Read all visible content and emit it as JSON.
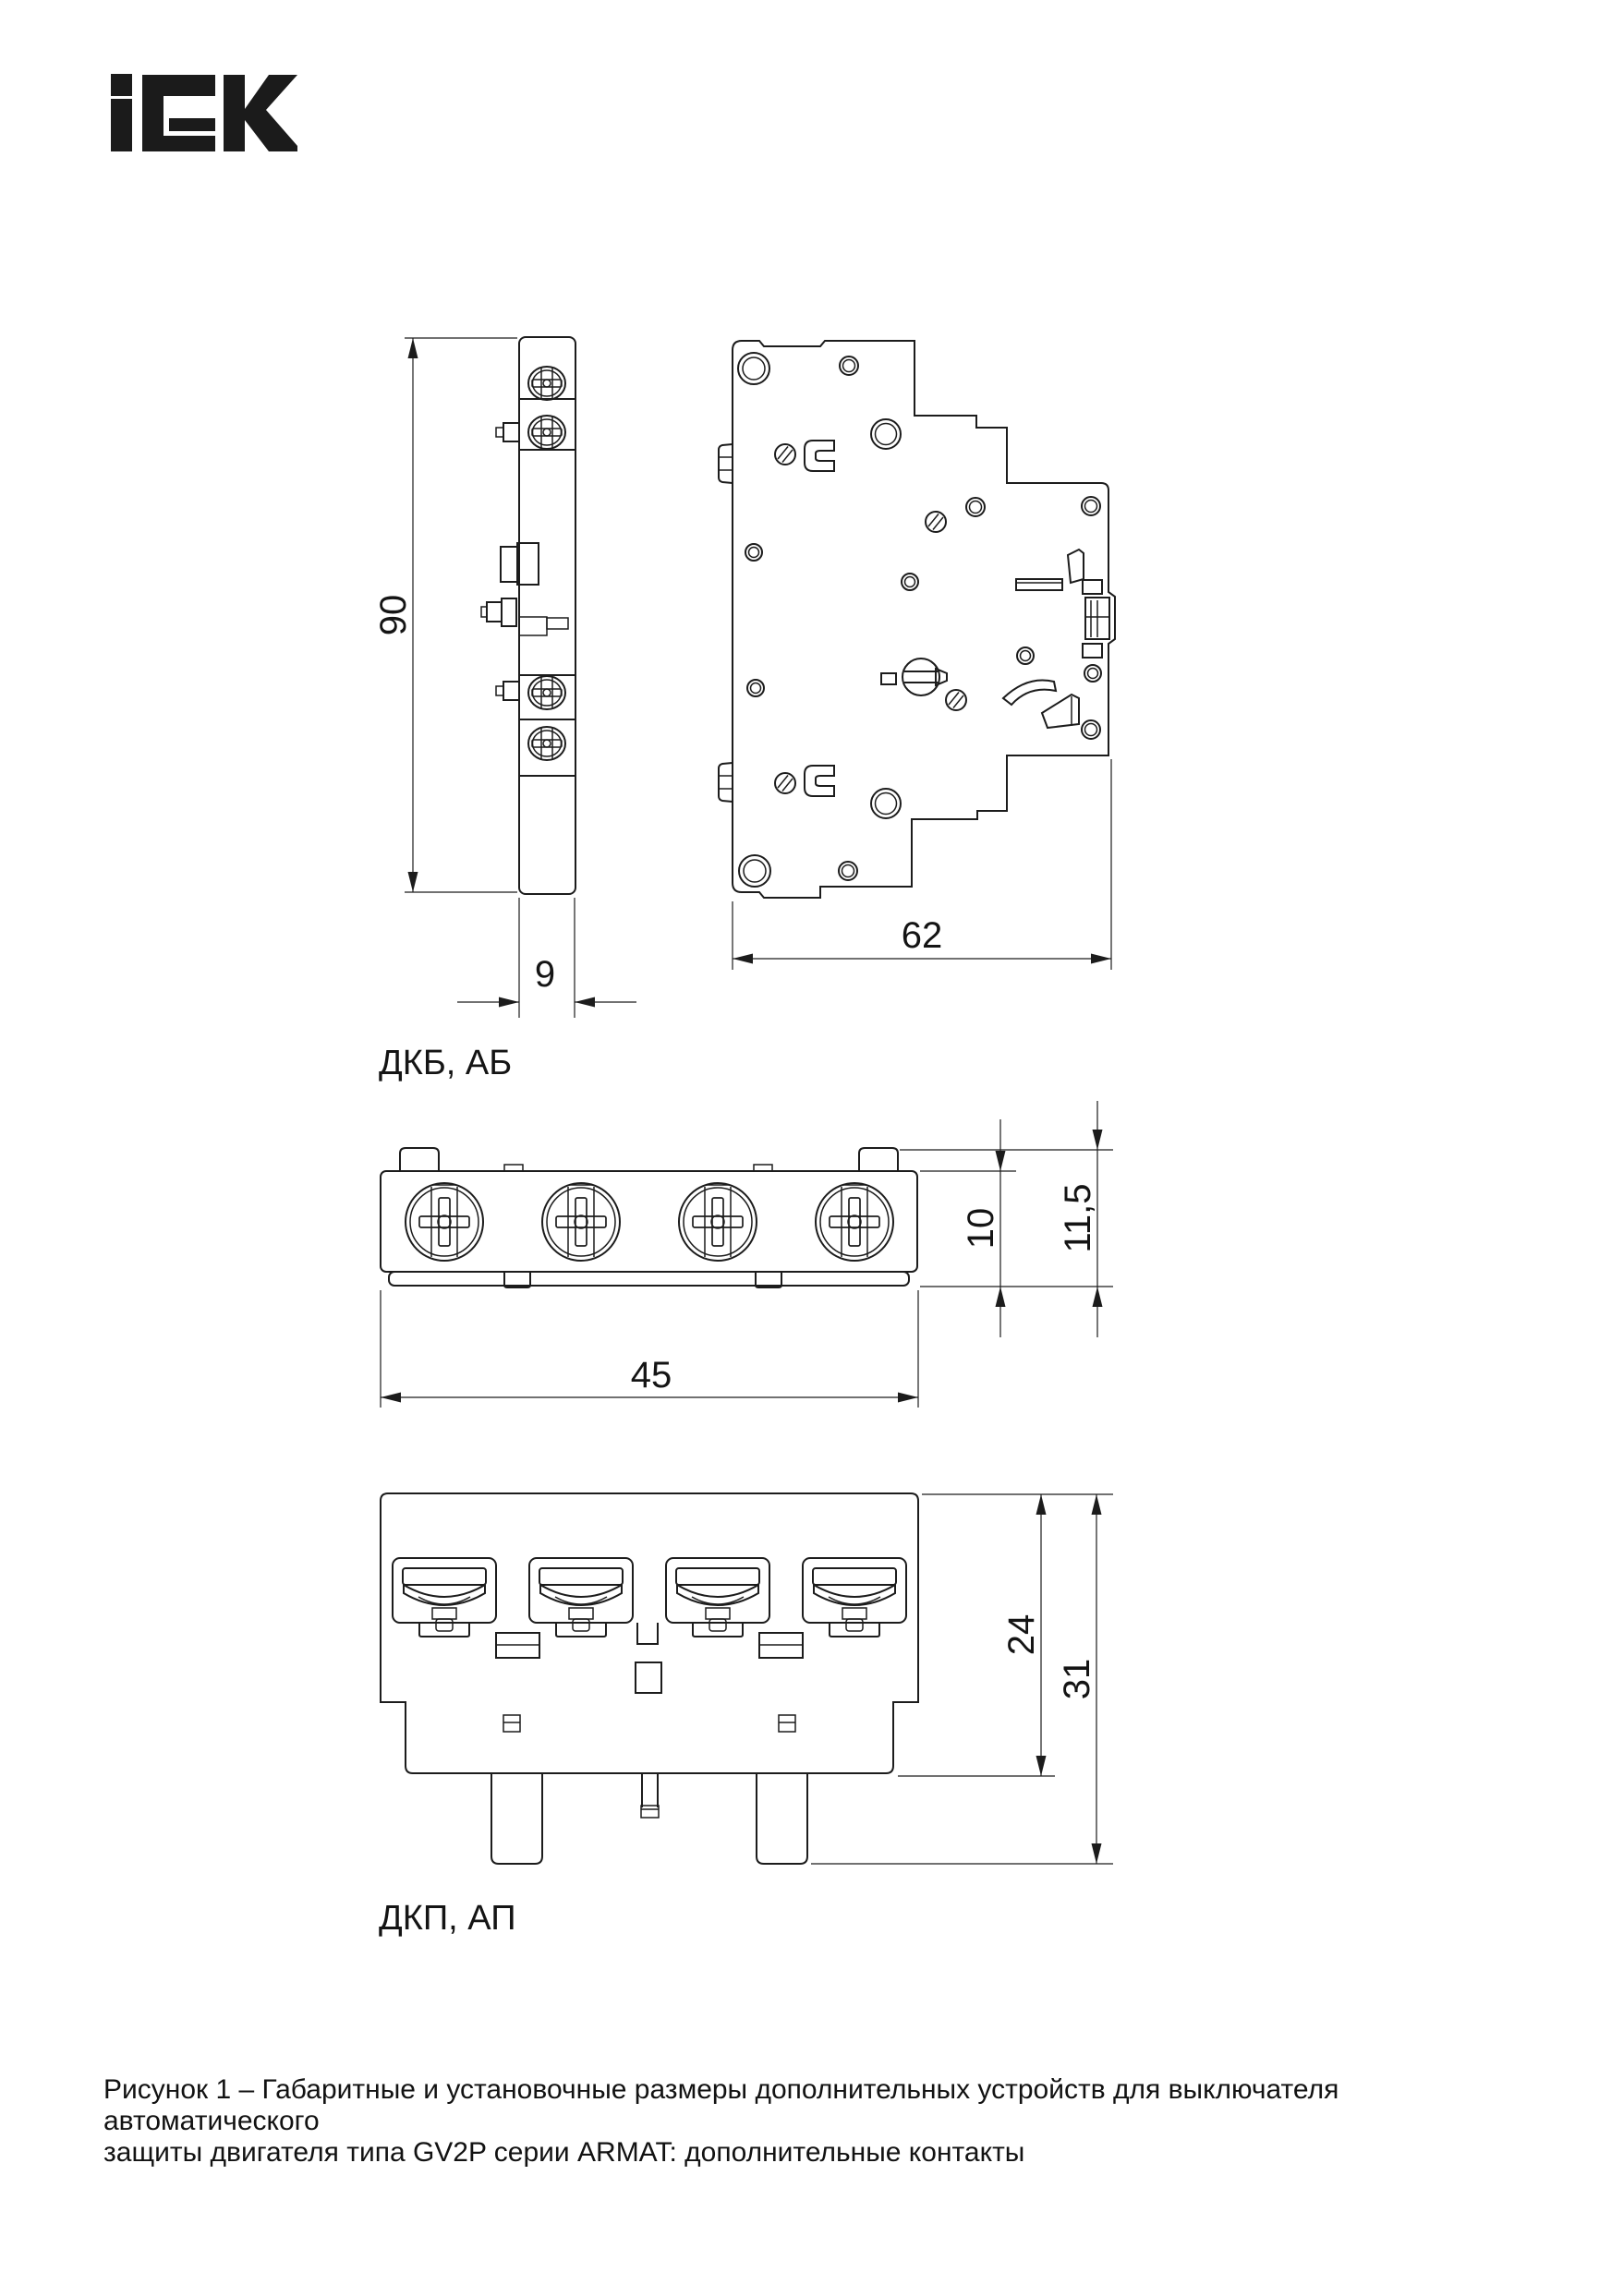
{
  "page": {
    "background": "#ffffff",
    "line_color": "#1c1c1c"
  },
  "logo": {
    "brand": "IEK"
  },
  "views": {
    "dkb": {
      "label": "ДКБ, АБ",
      "side": {
        "height_mm": "90",
        "width_mm": "9"
      },
      "profile": {
        "depth_mm": "62"
      }
    },
    "dkp": {
      "label": "ДКП, АП",
      "top": {
        "width_mm": "45",
        "body_height_mm": "10",
        "total_height_mm": "11,5"
      },
      "front": {
        "body_height_mm": "24",
        "total_height_mm": "31"
      }
    }
  },
  "caption": {
    "line1": "Рисунок 1 – Габаритные и установочные размеры дополнительных устройств для выключателя автоматического",
    "line2": "защиты двигателя типа GV2P серии ARMAT: дополнительные контакты"
  }
}
